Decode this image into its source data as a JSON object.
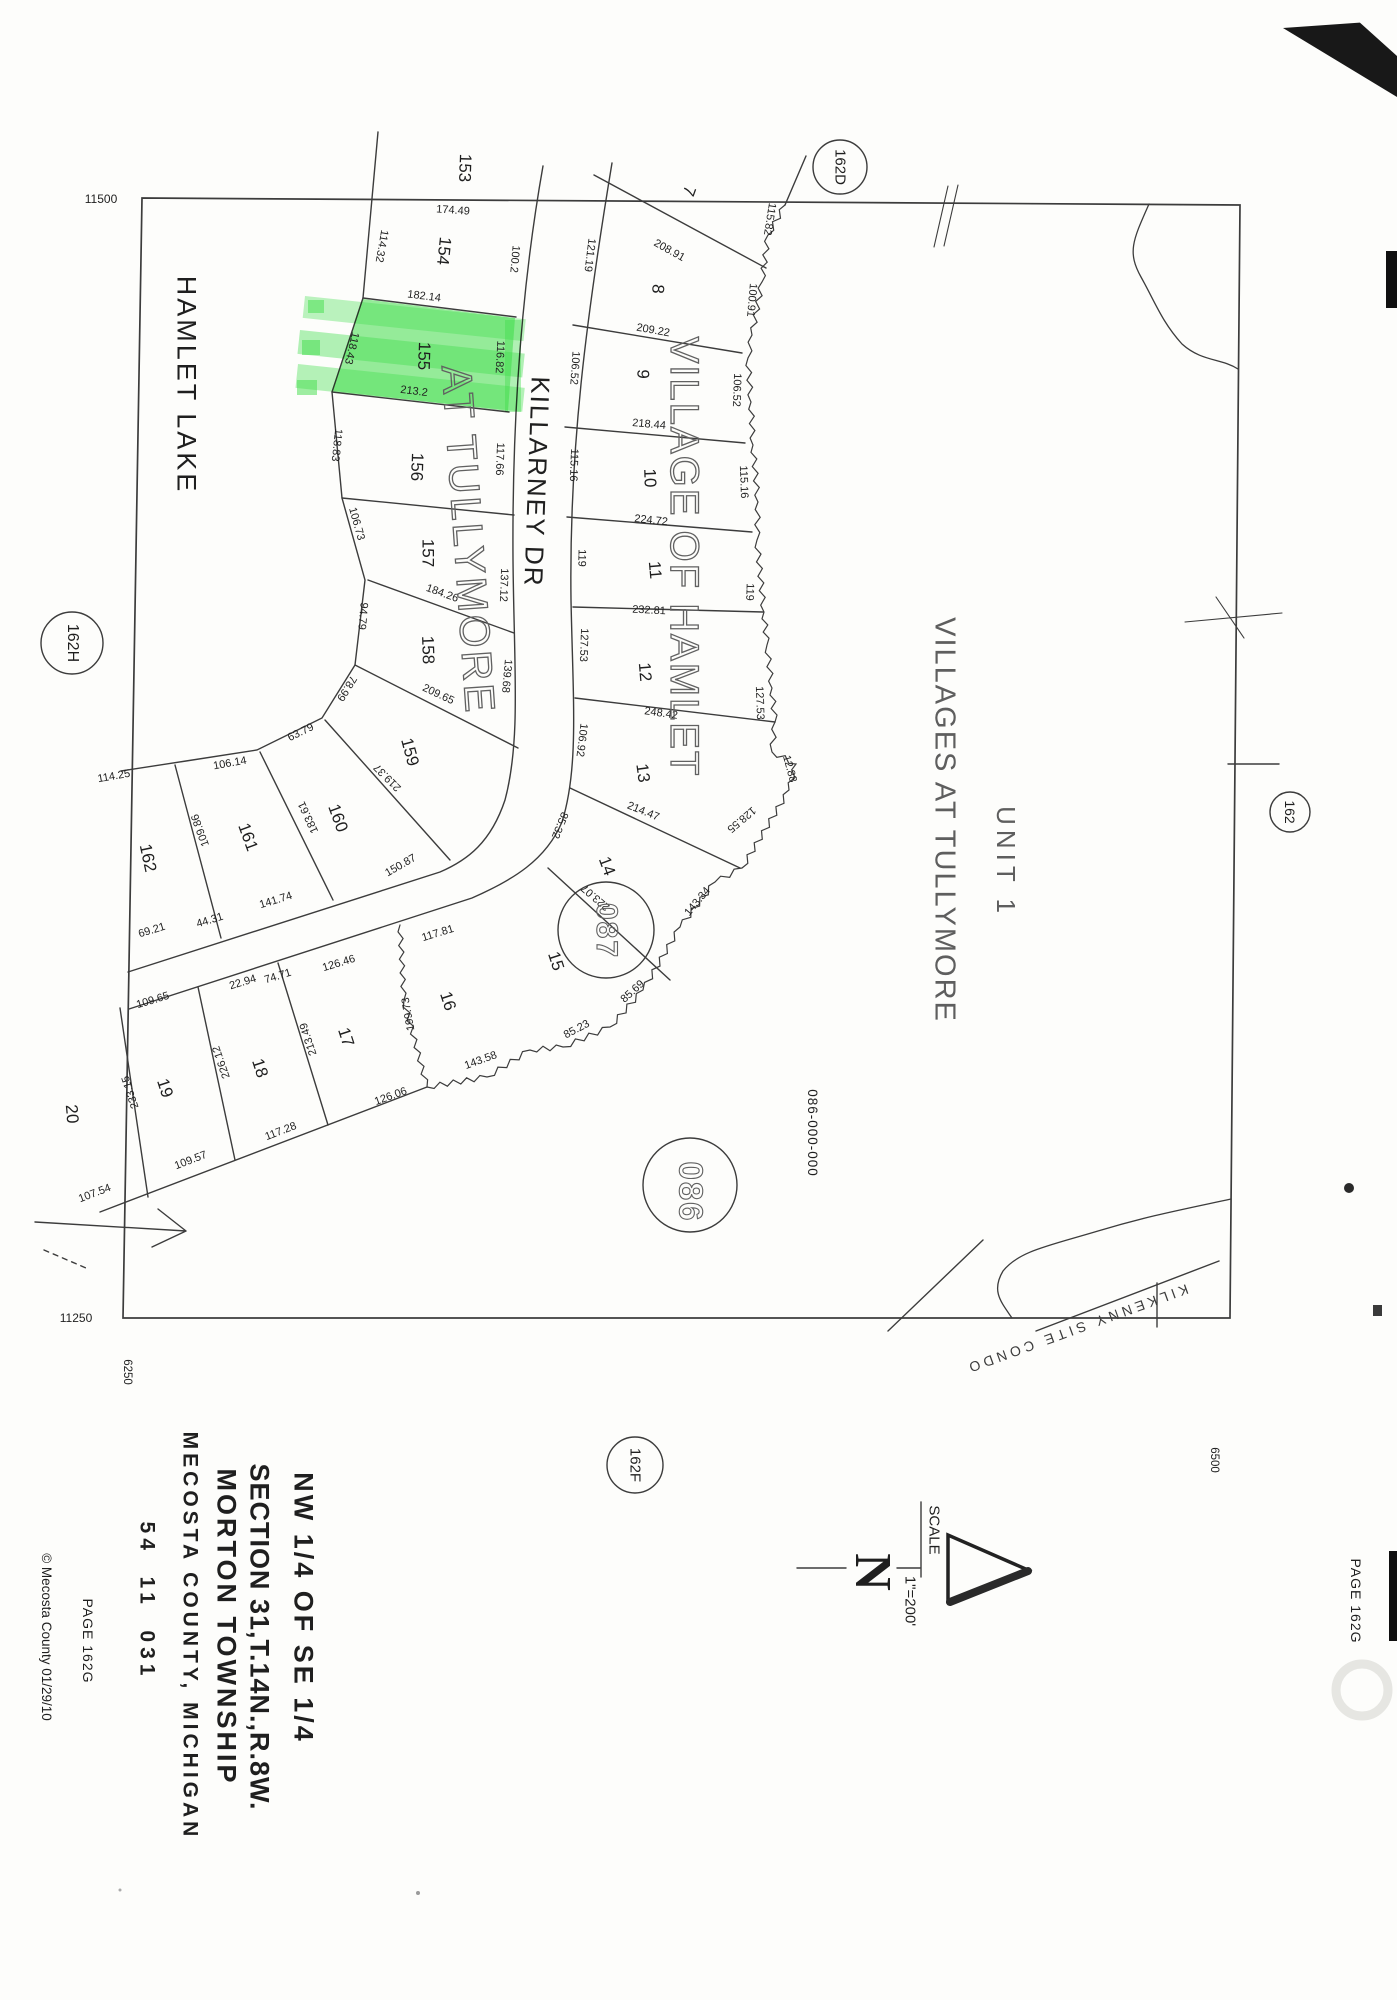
{
  "page": {
    "kind": "scanned plat map",
    "bg": "#fdfdfb"
  },
  "colors": {
    "line": "#3c3c3c",
    "highlight": "#3fdf4a",
    "text": "#1f1f1f",
    "outline_text": "#616161"
  },
  "labels": [
    {
      "n": "lot-number-153",
      "t": "153",
      "x": 465,
      "y": 168,
      "r": 92,
      "s": 17
    },
    {
      "n": "lot-number-154",
      "t": "154",
      "x": 444,
      "y": 251,
      "r": 96,
      "s": 17
    },
    {
      "n": "lot-number-155",
      "t": "155",
      "x": 424,
      "y": 356,
      "r": 92,
      "s": 17
    },
    {
      "n": "lot-number-156",
      "t": "156",
      "x": 417,
      "y": 467,
      "r": 92,
      "s": 17
    },
    {
      "n": "lot-number-157",
      "t": "157",
      "x": 428,
      "y": 553,
      "r": 90,
      "s": 17
    },
    {
      "n": "lot-number-158",
      "t": "158",
      "x": 428,
      "y": 650,
      "r": 88,
      "s": 17
    },
    {
      "n": "lot-number-159",
      "t": "159",
      "x": 410,
      "y": 752,
      "r": 75,
      "s": 17
    },
    {
      "n": "lot-number-160",
      "t": "160",
      "x": 338,
      "y": 818,
      "r": 70,
      "s": 17
    },
    {
      "n": "lot-number-161",
      "t": "161",
      "x": 248,
      "y": 837,
      "r": 70,
      "s": 17
    },
    {
      "n": "lot-number-162",
      "t": "162",
      "x": 148,
      "y": 858,
      "r": 78,
      "s": 17
    },
    {
      "n": "lot-number-7",
      "t": "7",
      "x": 689,
      "y": 191,
      "r": 110,
      "s": 17
    },
    {
      "n": "lot-number-8",
      "t": "8",
      "x": 658,
      "y": 289,
      "r": 95,
      "s": 17
    },
    {
      "n": "lot-number-9",
      "t": "9",
      "x": 643,
      "y": 374,
      "r": 92,
      "s": 17
    },
    {
      "n": "lot-number-10",
      "t": "10",
      "x": 650,
      "y": 478,
      "r": 88,
      "s": 17
    },
    {
      "n": "lot-number-11",
      "t": "11",
      "x": 655,
      "y": 570,
      "r": 85,
      "s": 17
    },
    {
      "n": "lot-number-12",
      "t": "12",
      "x": 645,
      "y": 672,
      "r": 85,
      "s": 17
    },
    {
      "n": "lot-number-13",
      "t": "13",
      "x": 643,
      "y": 773,
      "r": 82,
      "s": 17
    },
    {
      "n": "lot-number-14",
      "t": "14",
      "x": 607,
      "y": 866,
      "r": 70,
      "s": 17
    },
    {
      "n": "lot-number-15",
      "t": "15",
      "x": 556,
      "y": 961,
      "r": 72,
      "s": 17
    },
    {
      "n": "lot-number-16",
      "t": "16",
      "x": 448,
      "y": 1001,
      "r": 72,
      "s": 17
    },
    {
      "n": "lot-number-17",
      "t": "17",
      "x": 346,
      "y": 1037,
      "r": 72,
      "s": 17
    },
    {
      "n": "lot-number-18",
      "t": "18",
      "x": 260,
      "y": 1068,
      "r": 72,
      "s": 17
    },
    {
      "n": "lot-number-19",
      "t": "19",
      "x": 165,
      "y": 1088,
      "r": 72,
      "s": 17
    },
    {
      "n": "lot-number-20",
      "t": "20",
      "x": 72,
      "y": 1114,
      "r": 85,
      "s": 17
    },
    {
      "n": "dim-174-49",
      "t": "174.49",
      "x": 453,
      "y": 211,
      "r": 4,
      "s": 11
    },
    {
      "n": "dim-114-32",
      "t": "114.32",
      "x": 381,
      "y": 246,
      "r": 100,
      "s": 11
    },
    {
      "n": "dim-100-2",
      "t": "100.2",
      "x": 514,
      "y": 259,
      "r": 95,
      "s": 11
    },
    {
      "n": "dim-182-14",
      "t": "182.14",
      "x": 424,
      "y": 297,
      "r": 7,
      "s": 11
    },
    {
      "n": "dim-118-43",
      "t": "118.43",
      "x": 351,
      "y": 348,
      "r": 103,
      "s": 11
    },
    {
      "n": "dim-116-82",
      "t": "116.82",
      "x": 499,
      "y": 357,
      "r": 93,
      "s": 11
    },
    {
      "n": "dim-213-2",
      "t": "213.2",
      "x": 414,
      "y": 392,
      "r": 7,
      "s": 11
    },
    {
      "n": "dim-118-83",
      "t": "118.83",
      "x": 336,
      "y": 445,
      "r": 96,
      "s": 11
    },
    {
      "n": "dim-117-66",
      "t": "117.66",
      "x": 499,
      "y": 459,
      "r": 92,
      "s": 11
    },
    {
      "n": "dim-106-73",
      "t": "106.73",
      "x": 356,
      "y": 524,
      "r": 74,
      "s": 11
    },
    {
      "n": "dim-137-12",
      "t": "137.12",
      "x": 503,
      "y": 585,
      "r": 92,
      "s": 11
    },
    {
      "n": "dim-184-26",
      "t": "184.26",
      "x": 442,
      "y": 594,
      "r": 20,
      "s": 11
    },
    {
      "n": "dim-94-79",
      "t": "94.79",
      "x": 362,
      "y": 616,
      "r": 95,
      "s": 11
    },
    {
      "n": "dim-139-68",
      "t": "139.68",
      "x": 506,
      "y": 676,
      "r": 95,
      "s": 11
    },
    {
      "n": "dim-209-65",
      "t": "209.65",
      "x": 438,
      "y": 695,
      "r": 25,
      "s": 11
    },
    {
      "n": "dim-78-99",
      "t": "78.99",
      "x": 346,
      "y": 688,
      "r": 122,
      "s": 11
    },
    {
      "n": "dim-63-79",
      "t": "63.79",
      "x": 301,
      "y": 733,
      "r": 334,
      "s": 11
    },
    {
      "n": "dim-106-14",
      "t": "106.14",
      "x": 230,
      "y": 764,
      "r": 350,
      "s": 11
    },
    {
      "n": "dim-114-25",
      "t": "114.25",
      "x": 114,
      "y": 777,
      "r": 350,
      "s": 11
    },
    {
      "n": "dim-219-37",
      "t": "219.37",
      "x": 388,
      "y": 777,
      "r": 225,
      "s": 11
    },
    {
      "n": "dim-183-61",
      "t": "183.61",
      "x": 309,
      "y": 817,
      "r": 245,
      "s": 11
    },
    {
      "n": "dim-109-86",
      "t": "109.86",
      "x": 201,
      "y": 830,
      "r": 250,
      "s": 11
    },
    {
      "n": "dim-150-87",
      "t": "150.87",
      "x": 401,
      "y": 866,
      "r": 330,
      "s": 11
    },
    {
      "n": "dim-141-74",
      "t": "141.74",
      "x": 276,
      "y": 901,
      "r": 343,
      "s": 11
    },
    {
      "n": "dim-44-31",
      "t": "44.31",
      "x": 210,
      "y": 921,
      "r": 343,
      "s": 11
    },
    {
      "n": "dim-69-21",
      "t": "69.21",
      "x": 152,
      "y": 931,
      "r": 343,
      "s": 11
    },
    {
      "n": "dim-109-65",
      "t": "109.65",
      "x": 153,
      "y": 1001,
      "r": 343,
      "s": 11
    },
    {
      "n": "dim-22-94",
      "t": "22.94",
      "x": 243,
      "y": 983,
      "r": 343,
      "s": 11
    },
    {
      "n": "dim-74-71",
      "t": "74.71",
      "x": 278,
      "y": 977,
      "r": 343,
      "s": 11
    },
    {
      "n": "dim-126-46",
      "t": "126.46",
      "x": 339,
      "y": 964,
      "r": 343,
      "s": 11
    },
    {
      "n": "dim-117-81",
      "t": "117.81",
      "x": 438,
      "y": 934,
      "r": 343,
      "s": 11
    },
    {
      "n": "dim-199-73",
      "t": "199.73",
      "x": 409,
      "y": 1014,
      "r": 260,
      "s": 11
    },
    {
      "n": "dim-213-49",
      "t": "213.49",
      "x": 309,
      "y": 1039,
      "r": 252,
      "s": 11
    },
    {
      "n": "dim-226-12",
      "t": "226.12",
      "x": 222,
      "y": 1062,
      "r": 251,
      "s": 11
    },
    {
      "n": "dim-233-15",
      "t": "233.15",
      "x": 131,
      "y": 1092,
      "r": 252,
      "s": 11
    },
    {
      "n": "dim-126-06",
      "t": "126.06",
      "x": 391,
      "y": 1097,
      "r": 340,
      "s": 11
    },
    {
      "n": "dim-117-28",
      "t": "117.28",
      "x": 281,
      "y": 1132,
      "r": 339,
      "s": 11
    },
    {
      "n": "dim-109-57",
      "t": "109.57",
      "x": 191,
      "y": 1161,
      "r": 339,
      "s": 11
    },
    {
      "n": "dim-107-54",
      "t": "107.54",
      "x": 95,
      "y": 1194,
      "r": 339,
      "s": 11
    },
    {
      "n": "dim-143-58",
      "t": "143.58",
      "x": 481,
      "y": 1061,
      "r": 340,
      "s": 11
    },
    {
      "n": "dim-85-23",
      "t": "85.23",
      "x": 577,
      "y": 1030,
      "r": 332,
      "s": 11
    },
    {
      "n": "dim-85-69",
      "t": "85.69",
      "x": 633,
      "y": 992,
      "r": 318,
      "s": 11
    },
    {
      "n": "dim-143-34",
      "t": "143.34",
      "x": 698,
      "y": 902,
      "r": 310,
      "s": 11
    },
    {
      "n": "dim-128-55",
      "t": "128.55",
      "x": 741,
      "y": 819,
      "r": 140,
      "s": 11
    },
    {
      "n": "dim-12-88",
      "t": "12.88",
      "x": 789,
      "y": 769,
      "r": 75,
      "s": 11
    },
    {
      "n": "dim-223-07",
      "t": "223.07",
      "x": 596,
      "y": 897,
      "r": 221,
      "s": 11
    },
    {
      "n": "dim-214-47",
      "t": "214.47",
      "x": 643,
      "y": 812,
      "r": 22,
      "s": 11
    },
    {
      "n": "dim-248-42",
      "t": "248.42",
      "x": 661,
      "y": 714,
      "r": 8,
      "s": 11
    },
    {
      "n": "dim-232-81",
      "t": "232.81",
      "x": 649,
      "y": 611,
      "r": 3,
      "s": 11
    },
    {
      "n": "dim-224-72",
      "t": "224.72",
      "x": 651,
      "y": 521,
      "r": 6,
      "s": 11
    },
    {
      "n": "dim-218-44",
      "t": "218.44",
      "x": 649,
      "y": 425,
      "r": 5,
      "s": 11
    },
    {
      "n": "dim-209-22",
      "t": "209.22",
      "x": 653,
      "y": 331,
      "r": 10,
      "s": 11
    },
    {
      "n": "dim-208-91",
      "t": "208.91",
      "x": 669,
      "y": 251,
      "r": 29,
      "s": 11
    },
    {
      "n": "dim-121-19",
      "t": "121.19",
      "x": 589,
      "y": 255,
      "r": 97,
      "s": 11
    },
    {
      "n": "dim-106-52-w",
      "t": "106.52",
      "x": 574,
      "y": 368,
      "r": 94,
      "s": 11
    },
    {
      "n": "dim-115-16-w",
      "t": "115.16",
      "x": 573,
      "y": 465,
      "r": 92,
      "s": 11
    },
    {
      "n": "dim-119-w",
      "t": "119",
      "x": 581,
      "y": 558,
      "r": 91,
      "s": 11
    },
    {
      "n": "dim-127-53-w",
      "t": "127.53",
      "x": 583,
      "y": 645,
      "r": 92,
      "s": 11
    },
    {
      "n": "dim-106-92",
      "t": "106.92",
      "x": 581,
      "y": 740,
      "r": 97,
      "s": 11
    },
    {
      "n": "dim-85-32",
      "t": "85.32",
      "x": 559,
      "y": 825,
      "r": 112,
      "s": 11
    },
    {
      "n": "dim-115-82",
      "t": "115.82",
      "x": 769,
      "y": 219,
      "r": 99,
      "s": 11
    },
    {
      "n": "dim-100-91",
      "t": "100.91",
      "x": 751,
      "y": 300,
      "r": 95,
      "s": 11
    },
    {
      "n": "dim-106-52-e",
      "t": "106.52",
      "x": 736,
      "y": 390,
      "r": 92,
      "s": 11
    },
    {
      "n": "dim-115-16-e",
      "t": "115.16",
      "x": 743,
      "y": 482,
      "r": 88,
      "s": 11
    },
    {
      "n": "dim-119-e",
      "t": "119",
      "x": 749,
      "y": 592,
      "r": 92,
      "s": 11
    },
    {
      "n": "dim-127-53-e",
      "t": "127.53",
      "x": 759,
      "y": 703,
      "r": 88,
      "s": 11
    },
    {
      "n": "street-killarney-dr",
      "t": "KILLARNEY DR",
      "x": 537,
      "y": 482,
      "r": 92,
      "s": 26,
      "ls": 2
    },
    {
      "n": "water-hamlet-lake",
      "t": "HAMLET LAKE",
      "x": 186,
      "y": 385,
      "r": 90,
      "s": 27,
      "ls": 3
    },
    {
      "n": "subdivision-village-of-hamlet",
      "t": "VILLAGE OF HAMLET",
      "x": 684,
      "y": 557,
      "r": 90,
      "s": 40,
      "ls": 2,
      "o": true
    },
    {
      "n": "subdivision-at-tullymore",
      "t": "AT TULLYMORE",
      "x": 468,
      "y": 540,
      "r": 86,
      "s": 42,
      "ls": 3,
      "o": true
    },
    {
      "n": "unit-label",
      "t": "UNIT 1",
      "x": 1006,
      "y": 862,
      "r": 90,
      "s": 26,
      "ls": 5,
      "c": "#5e5e5e"
    },
    {
      "n": "subdivision-villages-at-tullymore",
      "t": "VILLAGES AT TULLYMORE",
      "x": 944,
      "y": 820,
      "r": 90,
      "s": 29,
      "ls": 2,
      "c": "#5e5e5e"
    },
    {
      "n": "parcel-circle-086-text",
      "t": "086",
      "x": 691,
      "y": 1192,
      "r": 90,
      "s": 33,
      "ls": 2,
      "w": 700,
      "o": true
    },
    {
      "n": "parcel-circle-087-text",
      "t": "087",
      "x": 606,
      "y": 931,
      "r": 90,
      "s": 30,
      "ls": 2,
      "w": 700,
      "o": true
    },
    {
      "n": "parcel-id",
      "t": "086-000-000",
      "x": 812,
      "y": 1133,
      "r": 90,
      "s": 13.5,
      "ls": 1
    },
    {
      "n": "kilkenny-site-condo",
      "t": "KILKENNY SITE CONDO",
      "x": 1077,
      "y": 1329,
      "r": 160,
      "s": 14,
      "ls": 4,
      "c": "#3c3c3c"
    },
    {
      "n": "page-ref-162d",
      "t": "162D",
      "x": 840,
      "y": 167,
      "r": 90,
      "s": 15
    },
    {
      "n": "page-ref-162h",
      "t": "162H",
      "x": 72,
      "y": 643,
      "r": 90,
      "s": 16
    },
    {
      "n": "page-ref-162",
      "t": "162",
      "x": 1290,
      "y": 812,
      "r": 90,
      "s": 14
    },
    {
      "n": "page-ref-162f",
      "t": "162F",
      "x": 635,
      "y": 1465,
      "r": 90,
      "s": 15
    },
    {
      "n": "scale-word",
      "t": "SCALE",
      "x": 934,
      "y": 1530,
      "r": 90,
      "s": 15
    },
    {
      "n": "scale-value",
      "t": "1\"=200'",
      "x": 910,
      "y": 1601,
      "r": 90,
      "s": 15
    },
    {
      "n": "north-letter",
      "t": "N",
      "x": 872,
      "y": 1572,
      "r": 90,
      "s": 52,
      "w": 700,
      "f": "serif"
    },
    {
      "n": "title-quarter",
      "t": "NW 1/4 OF SE 1/4",
      "x": 303,
      "y": 1608,
      "r": 90,
      "s": 27,
      "w": 700,
      "ls": 3
    },
    {
      "n": "title-section",
      "t": "SECTION 31,T.14N.,R.8W.",
      "x": 259,
      "y": 1637,
      "r": 90,
      "s": 27,
      "w": 700,
      "ls": 1
    },
    {
      "n": "title-township",
      "t": "MORTON TOWNSHIP",
      "x": 226,
      "y": 1627,
      "r": 90,
      "s": 27,
      "w": 700,
      "ls": 3
    },
    {
      "n": "title-county",
      "t": "MECOSTA COUNTY, MICHIGAN",
      "x": 190,
      "y": 1636,
      "r": 90,
      "s": 21,
      "w": 700,
      "ls": 4
    },
    {
      "n": "title-parcel-code",
      "t": "54  11  031",
      "x": 147,
      "y": 1601,
      "r": 90,
      "s": 21,
      "w": 700,
      "ls": 5
    },
    {
      "n": "page-label-left",
      "t": "PAGE 162G",
      "x": 88,
      "y": 1641,
      "r": 90,
      "s": 14,
      "ls": 1
    },
    {
      "n": "copyright-note",
      "t": "© Mecosta County 01/29/10",
      "x": 46,
      "y": 1637,
      "r": 90,
      "s": 13.5
    },
    {
      "n": "page-label-right",
      "t": "PAGE 162G",
      "x": 1356,
      "y": 1601,
      "r": 90,
      "s": 14,
      "ls": 1
    },
    {
      "n": "grid-coord-11500",
      "t": "11500",
      "x": 101,
      "y": 199,
      "r": 0,
      "s": 12
    },
    {
      "n": "grid-coord-11250",
      "t": "11250",
      "x": 76,
      "y": 1318,
      "r": 0,
      "s": 12
    },
    {
      "n": "grid-coord-6250",
      "t": "6250",
      "x": 126,
      "y": 1372,
      "r": 90,
      "s": 11.5
    },
    {
      "n": "grid-coord-6500",
      "t": "6500",
      "x": 1213,
      "y": 1460,
      "r": 90,
      "s": 11.5
    }
  ]
}
